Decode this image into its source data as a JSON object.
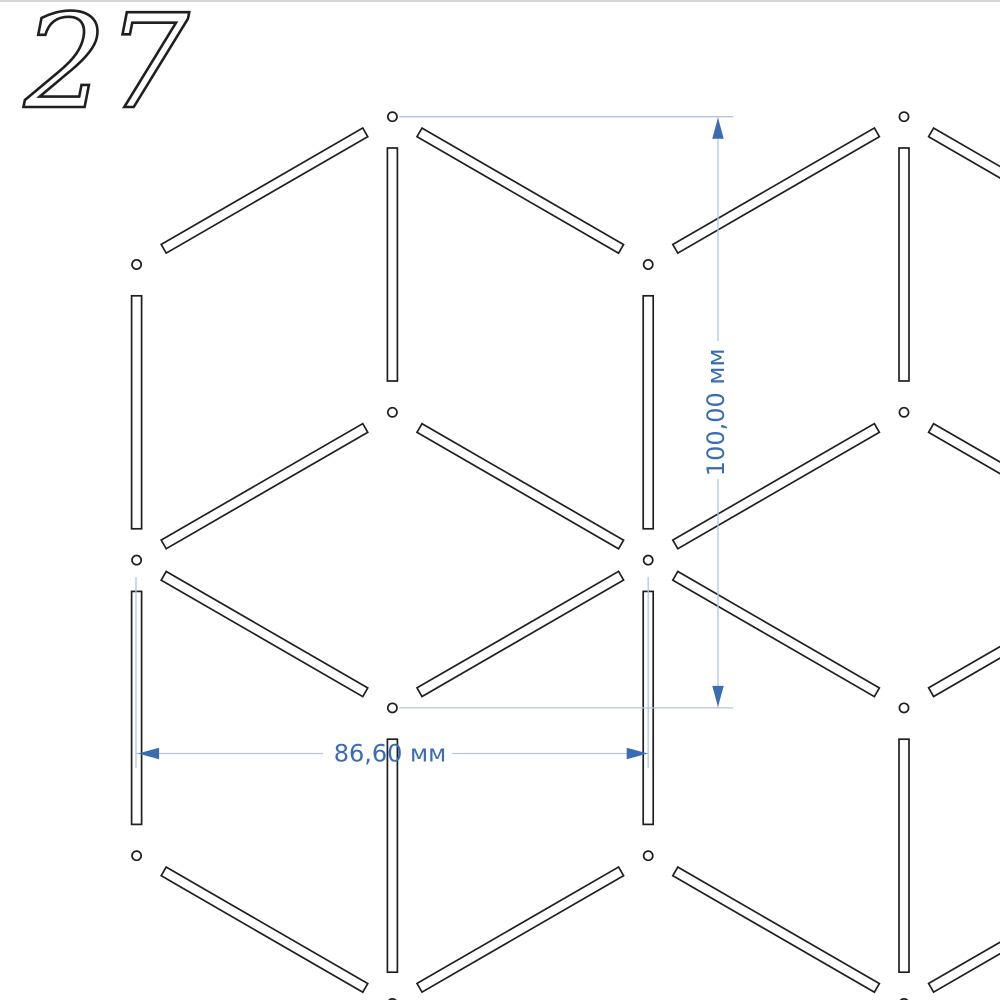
{
  "sheet": {
    "number": "27"
  },
  "colors": {
    "background": "#ffffff",
    "cut_stroke": "#1f1f1f",
    "dim_accent": "#3a6cb4",
    "dim_light": "#b3c5e0",
    "canvas_top_border": "#c6c6c6"
  },
  "lattice": {
    "origin_x": 136.6,
    "origin_y": 116.7,
    "col_pitch": 255.8,
    "row_pitch": 147.8,
    "slat_width": 10,
    "slat_end_gap": 31.3,
    "node_radius": 4.6,
    "stroke_width": 1.7
  },
  "pattern": {
    "nodes": [
      [
        1,
        0
      ],
      [
        3,
        0
      ],
      [
        0,
        1
      ],
      [
        2,
        1
      ],
      [
        1,
        2
      ],
      [
        3,
        2
      ],
      [
        0,
        3
      ],
      [
        2,
        3
      ],
      [
        1,
        4
      ],
      [
        3,
        4
      ],
      [
        0,
        5
      ],
      [
        2,
        5
      ],
      [
        1,
        6
      ],
      [
        3,
        6
      ]
    ],
    "slats": [
      [
        [
          1,
          0
        ],
        [
          1,
          2
        ]
      ],
      [
        [
          3,
          0
        ],
        [
          3,
          2
        ]
      ],
      [
        [
          0,
          1
        ],
        [
          0,
          3
        ]
      ],
      [
        [
          2,
          1
        ],
        [
          2,
          3
        ]
      ],
      [
        [
          0,
          3
        ],
        [
          0,
          5
        ]
      ],
      [
        [
          2,
          3
        ],
        [
          2,
          5
        ]
      ],
      [
        [
          1,
          4
        ],
        [
          1,
          6
        ]
      ],
      [
        [
          3,
          4
        ],
        [
          3,
          6
        ]
      ],
      [
        [
          1,
          0
        ],
        [
          2,
          1
        ]
      ],
      [
        [
          3,
          0
        ],
        [
          4,
          1
        ]
      ],
      [
        [
          1,
          2
        ],
        [
          2,
          3
        ]
      ],
      [
        [
          3,
          2
        ],
        [
          4,
          3
        ]
      ],
      [
        [
          0,
          3
        ],
        [
          1,
          4
        ]
      ],
      [
        [
          2,
          3
        ],
        [
          3,
          4
        ]
      ],
      [
        [
          0,
          5
        ],
        [
          1,
          6
        ]
      ],
      [
        [
          2,
          5
        ],
        [
          3,
          6
        ]
      ],
      [
        [
          0,
          1
        ],
        [
          1,
          0
        ]
      ],
      [
        [
          2,
          1
        ],
        [
          3,
          0
        ]
      ],
      [
        [
          0,
          3
        ],
        [
          1,
          2
        ]
      ],
      [
        [
          2,
          3
        ],
        [
          3,
          2
        ]
      ],
      [
        [
          1,
          4
        ],
        [
          2,
          3
        ]
      ],
      [
        [
          3,
          4
        ],
        [
          4,
          3
        ]
      ],
      [
        [
          1,
          6
        ],
        [
          2,
          5
        ]
      ],
      [
        [
          3,
          6
        ],
        [
          4,
          5
        ]
      ]
    ]
  },
  "dimensions": {
    "style": {
      "arrow_length": 21,
      "arrow_width": 11.5,
      "line_width": 1.3,
      "font_size": 24
    },
    "vertical": {
      "label": "100,00 мм",
      "value_mm": 100.0,
      "line_x": 718,
      "y1": 116.7,
      "y2": 707.9,
      "text_gap": [
        341,
        479
      ],
      "ext_lines": [
        {
          "x1": 399.3,
          "x2": 733.3,
          "y": 116.7
        },
        {
          "x1": 399.3,
          "x2": 733.3,
          "y": 707.9
        }
      ]
    },
    "horizontal": {
      "label": "86,60 мм",
      "value_mm": 86.6,
      "line_y": 753.5,
      "x1": 136.6,
      "x2": 648.2,
      "text_gap": [
        323,
        452
      ],
      "ext_lines": [
        {
          "x": 136.0,
          "y1": 577,
          "y2": 768
        },
        {
          "x": 648.2,
          "y1": 577,
          "y2": 768
        }
      ]
    }
  }
}
